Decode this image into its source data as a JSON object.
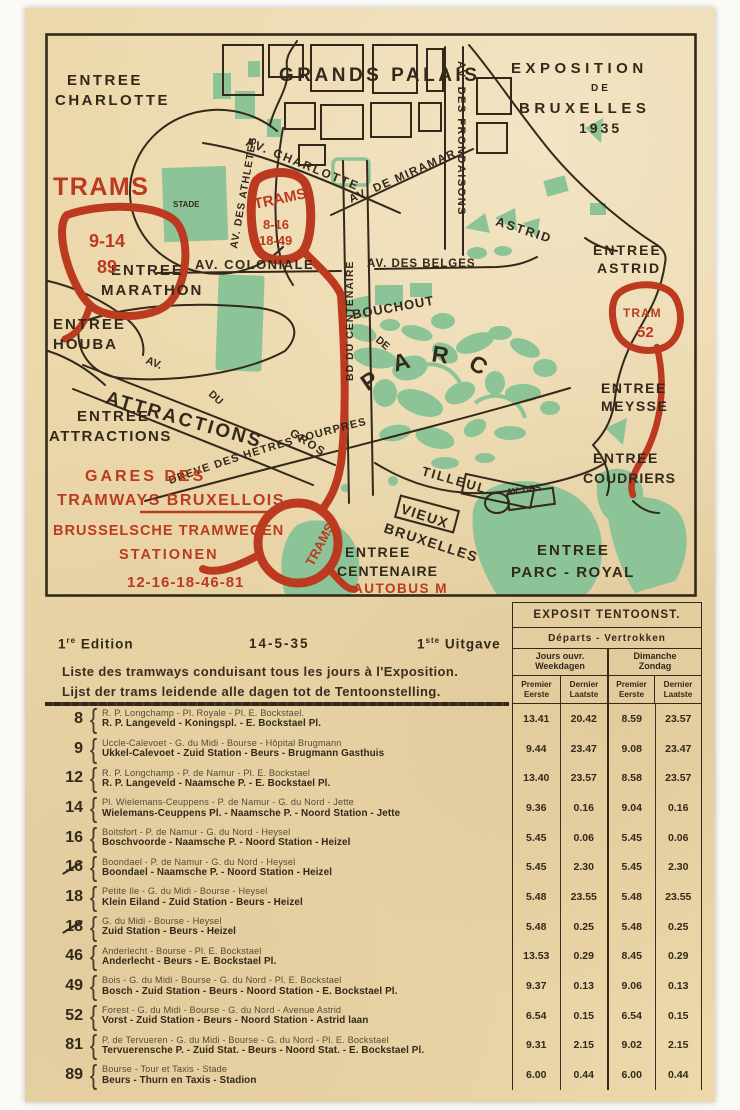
{
  "colors": {
    "paper": "#ecd8ab",
    "ink": "#33291b",
    "red": "#bc3a1f",
    "green": "#8dc497"
  },
  "map": {
    "labels": {
      "entree_charlotte_1": "ENTREE",
      "entree_charlotte_2": "CHARLOTTE",
      "grands_palais": "GRANDS PALAIS",
      "expo_1": "EXPOSITION",
      "expo_2": "DE",
      "expo_3": "BRUXELLES",
      "expo_4": "1935",
      "trams_left": "TRAMS",
      "trams_left_lines_1": "9-14",
      "trams_left_lines_2": "89",
      "trams_mid": "TRAMS",
      "trams_mid_lines_1": "8-16",
      "trams_mid_lines_2": "18-49",
      "stade": "STADE",
      "av_charlotte": "AV. CHARLOTTE",
      "av_miramar": "AV. DE MIRAMAR",
      "av_frondaisons": "AV. DES FRONDAISONS",
      "av_athletes": "AV. DES ATHLETES",
      "av_coloniale": "AV. COLONIALE",
      "av_des_belges": "AV. DES BELGES",
      "bd_centenaire": "BD DU CENTENAIRE",
      "astrid_street": "ASTRID",
      "entree_astrid_1": "ENTREE",
      "entree_astrid_2": "ASTRID",
      "tram52_1": "TRAM",
      "tram52_2": "52",
      "entree_marathon_1": "ENTREE",
      "entree_marathon_2": "MARATHON",
      "entree_houba_1": "ENTREE",
      "entree_houba_2": "HOUBA",
      "av_frag": "AV.",
      "du_frag": "DU",
      "gros_frag": "GROS",
      "de_frag": "DE",
      "attractions": "ATTRACTIONS",
      "entree_attractions_1": "ENTREE",
      "entree_attractions_2": "ATTRACTIONS",
      "bouchout": "BOUCHOUT",
      "parc": "PARC",
      "dreve": "DREVE DES HETRES POURPRES",
      "entree_meysse_1": "ENTREE",
      "entree_meysse_2": "MEYSSE",
      "entree_coudriers_1": "ENTREE",
      "entree_coudriers_2": "COUDRIERS",
      "av_des_frag": "AV. DES",
      "tilleul": "TILLEUL",
      "vieux_1": "VIEUX",
      "vieux_2": "BRUXELLES",
      "entree_centenaire_1": "ENTREE",
      "entree_centenaire_2": "CENTENAIRE",
      "entree_parc_royal_1": "ENTREE",
      "entree_parc_royal_2": "PARC - ROYAL",
      "autobus": "AUTOBUS M",
      "trams_loop": "TRAMS",
      "gares_1": "GARES DES",
      "gares_2": "TRAMWAYS BRUXELLOIS",
      "gares_nl_1": "BRUSSELSCHE TRAMWEGEN",
      "gares_nl_2": "STATIONEN",
      "gares_lines": "12-16-18-46-81"
    }
  },
  "edition": {
    "fr_num": "1",
    "fr_sup": "re",
    "fr_word": "Edition",
    "date": "14-5-35",
    "nl_num": "1",
    "nl_sup": "ste",
    "nl_word": "Uitgave"
  },
  "intro": {
    "fr": "Liste des tramways conduisant tous les jours à l'Exposition.",
    "nl": "Lijst der trams leidende alle dagen tot de Tentoonstelling."
  },
  "table": {
    "header": {
      "title": "EXPOSIT TENTOONST.",
      "subtitle": "Départs - Vertrokken",
      "col1_fr": "Jours ouvr.",
      "col1_nl": "Weekdagen",
      "col2_fr": "Dimanche",
      "col2_nl": "Zondag",
      "first_fr": "Premier",
      "first_nl": "Eerste",
      "last_fr": "Dernier",
      "last_nl": "Laatste"
    },
    "rows": [
      {
        "line": "8",
        "barre": false,
        "fr": "R. P. Longchamp - Pl. Royale - Pl. E. Bockstael.",
        "nl": "R. P. Langeveld - Koningspl. - E. Bockstael Pl.",
        "t": [
          "13.41",
          "20.42",
          "8.59",
          "23.57"
        ]
      },
      {
        "line": "9",
        "barre": false,
        "fr": "Uccle-Calevoet - G. du Midi - Bourse - Hôpital Brugmann",
        "nl": "Ukkel-Calevoet - Zuid Station - Beurs - Brugmann Gasthuis",
        "t": [
          "9.44",
          "23.47",
          "9.08",
          "23.47"
        ]
      },
      {
        "line": "12",
        "barre": false,
        "fr": "R. P. Longchamp - P. de Namur - Pl. E. Bockstael",
        "nl": "R. P. Langeveld - Naamsche P. - E. Bockstael Pl.",
        "t": [
          "13.40",
          "23.57",
          "8.58",
          "23.57"
        ]
      },
      {
        "line": "14",
        "barre": false,
        "fr": "Pl. Wielemans-Ceuppens - P. de Namur - G. du Nord - Jette",
        "nl": "Wielemans-Ceuppens Pl. - Naamsche P. - Noord Station - Jette",
        "t": [
          "9.36",
          "0.16",
          "9.04",
          "0.16"
        ]
      },
      {
        "line": "16",
        "barre": false,
        "fr": "Boitsfort - P. de Namur - G. du Nord - Heysel",
        "nl": "Boschvoorde - Naamsche P. - Noord Station - Heizel",
        "t": [
          "5.45",
          "0.06",
          "5.45",
          "0.06"
        ]
      },
      {
        "line": "16",
        "barre": true,
        "fr": "Boondael - P. de Namur - G. du Nord - Heysel",
        "nl": "Boondael - Naamsche P. - Noord Station - Heizel",
        "t": [
          "5.45",
          "2.30",
          "5.45",
          "2.30"
        ]
      },
      {
        "line": "18",
        "barre": false,
        "fr": "Petite Ile - G. du Midi - Bourse - Heysel",
        "nl": "Klein Eiland - Zuid Station - Beurs - Heizel",
        "t": [
          "5.48",
          "23.55",
          "5.48",
          "23.55"
        ]
      },
      {
        "line": "18",
        "barre": true,
        "fr": "G. du Midi - Bourse - Heysel",
        "nl": "Zuid Station - Beurs - Heizel",
        "t": [
          "5.48",
          "0.25",
          "5.48",
          "0.25"
        ]
      },
      {
        "line": "46",
        "barre": false,
        "fr": "Anderlecht - Bourse - Pl. E. Bockstael",
        "nl": "Anderlecht - Beurs - E. Bockstael Pl.",
        "t": [
          "13.53",
          "0.29",
          "8.45",
          "0.29"
        ]
      },
      {
        "line": "49",
        "barre": false,
        "fr": "Bois - G. du Midi - Bourse - G. du Nord - Pl. E. Bockstael",
        "nl": "Bosch - Zuid Station - Beurs - Noord Station - E. Bockstael Pl.",
        "t": [
          "9.37",
          "0.13",
          "9.06",
          "0.13"
        ]
      },
      {
        "line": "52",
        "barre": false,
        "fr": "Forest - G. du Midi - Bourse - G. du Nord - Avenue Astrid",
        "nl": "Vorst - Zuid Station - Beurs - Noord Station - Astrid laan",
        "t": [
          "6.54",
          "0.15",
          "6.54",
          "0.15"
        ]
      },
      {
        "line": "81",
        "barre": false,
        "fr": "P. de Tervueren - G. du Midi - Bourse - G. du Nord - Pl. E. Bockstael",
        "nl": "Tervuerensche P. - Zuid Stat. - Beurs - Noord Stat. - E. Bockstael Pl.",
        "t": [
          "9.31",
          "2.15",
          "9.02",
          "2.15"
        ]
      },
      {
        "line": "89",
        "barre": false,
        "fr": "Bourse - Tour et Taxis - Stade",
        "nl": "Beurs - Thurn en Taxis - Stadion",
        "t": [
          "6.00",
          "0.44",
          "6.00",
          "0.44"
        ]
      }
    ]
  }
}
